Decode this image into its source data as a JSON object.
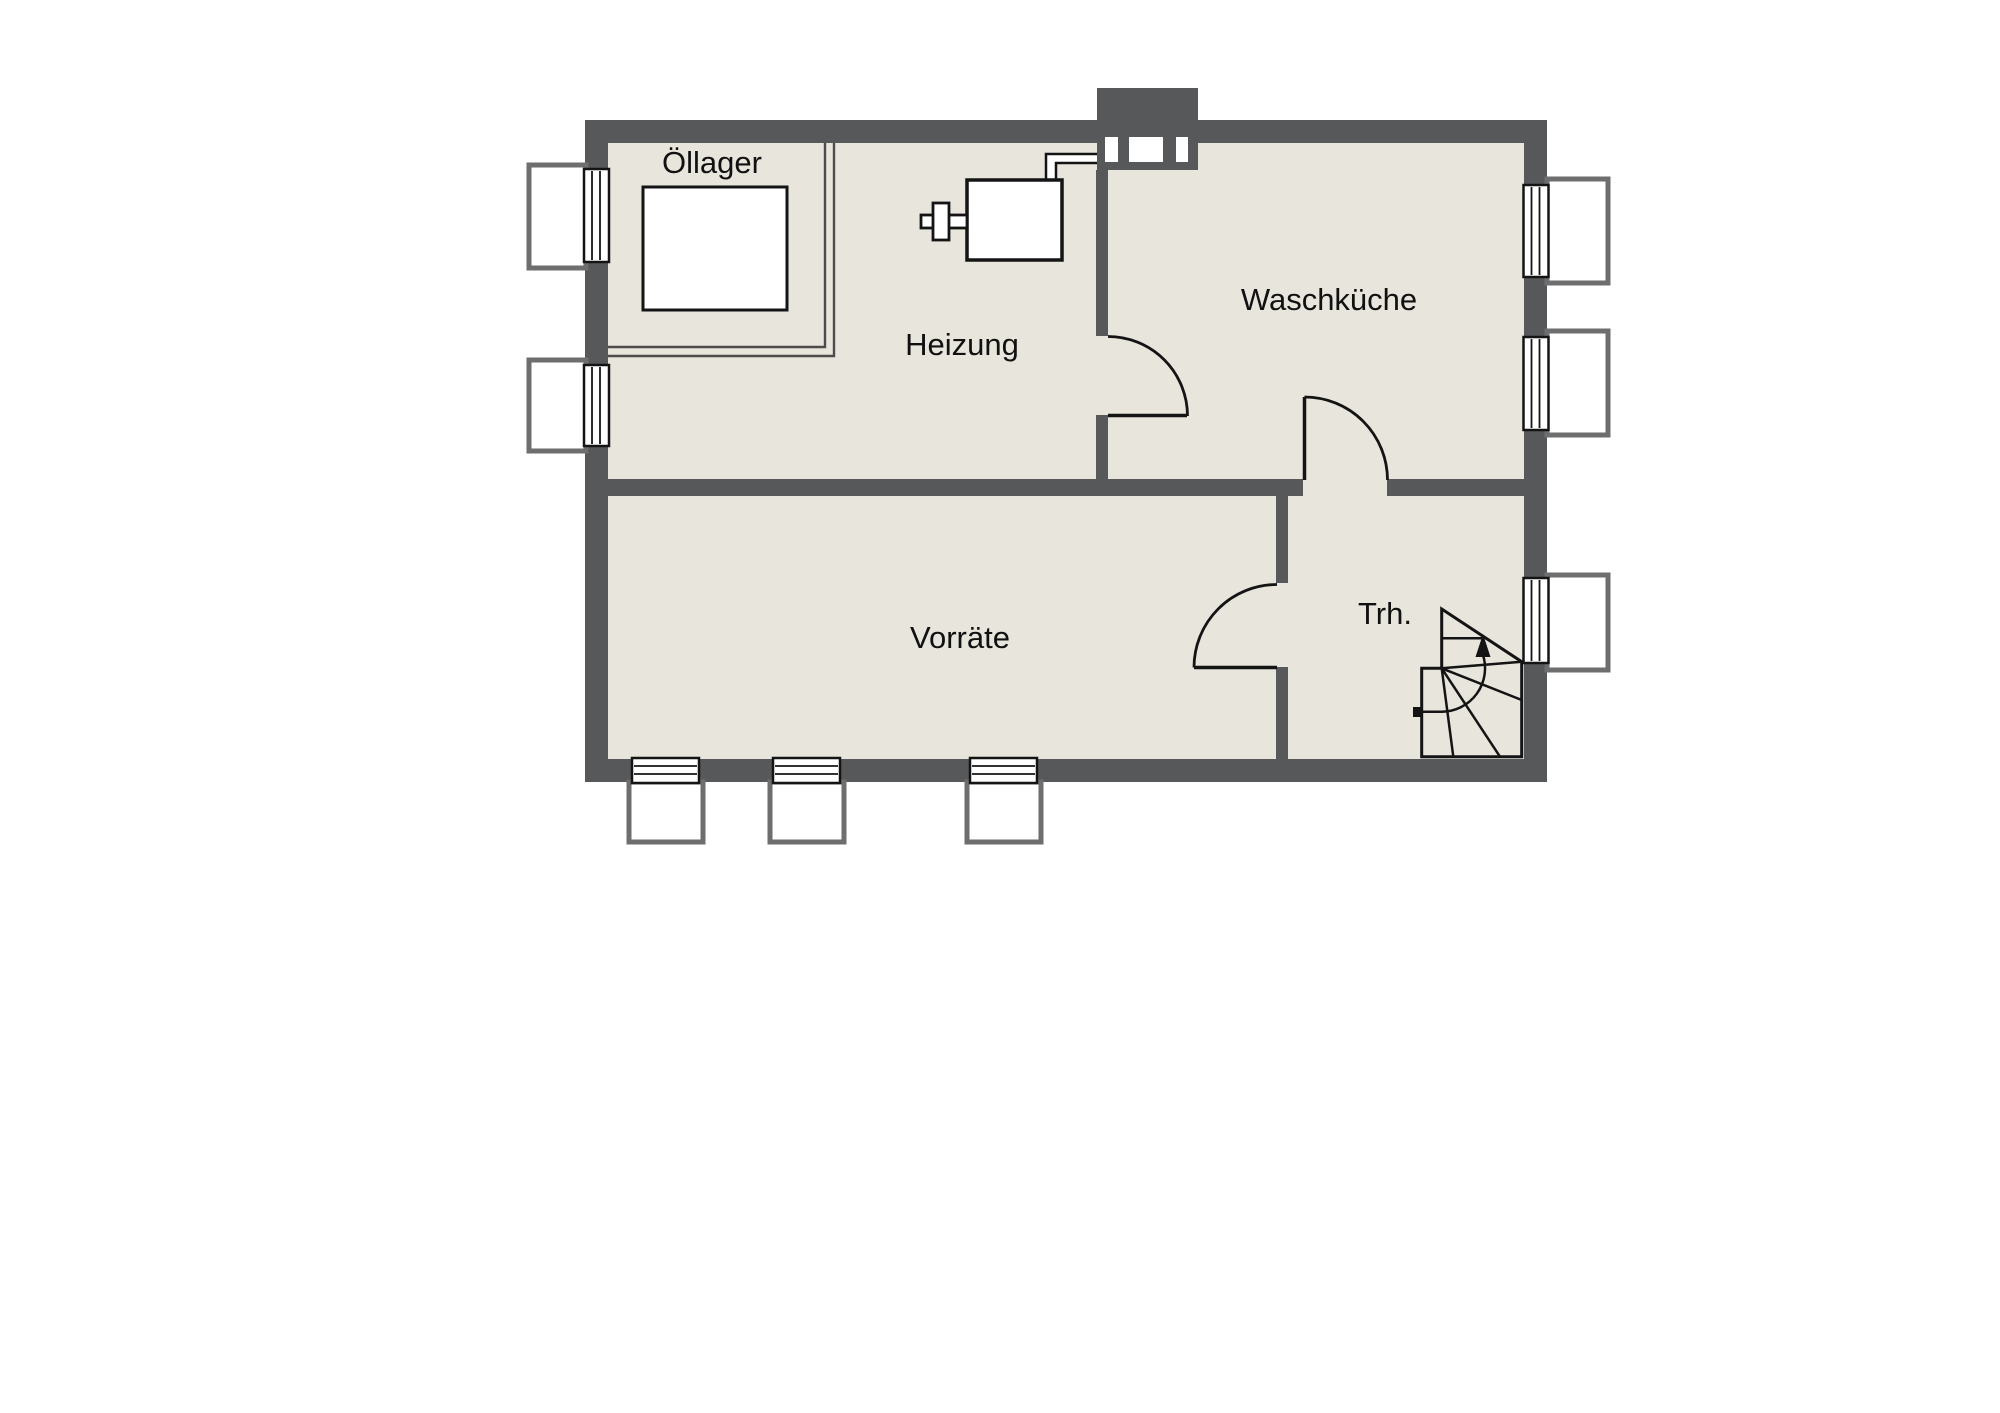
{
  "rooms": [
    {
      "id": "oellager",
      "label": "Öllager"
    },
    {
      "id": "heizung",
      "label": "Heizung"
    },
    {
      "id": "waschkueche",
      "label": "Waschküche"
    },
    {
      "id": "vorraete",
      "label": "Vorräte"
    },
    {
      "id": "trh",
      "label": "Trh."
    }
  ],
  "colors": {
    "wall": "#57585a",
    "floor": "#e8e5dc",
    "line": "#141414",
    "sill": "#6e6e6e",
    "background": "#ffffff"
  }
}
